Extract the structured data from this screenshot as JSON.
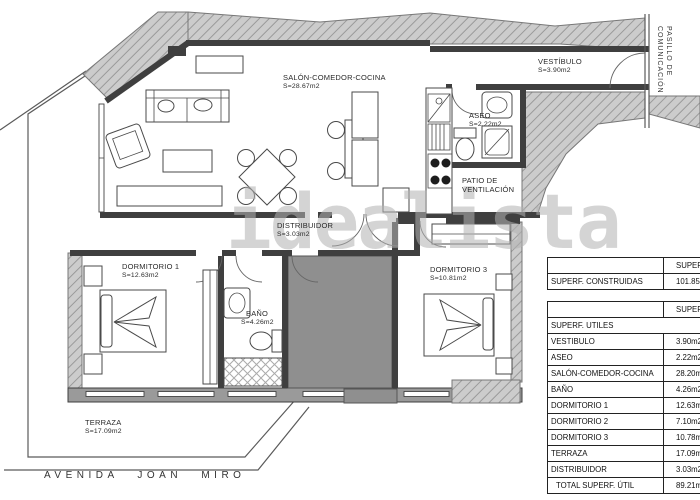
{
  "watermark_text": "idealista",
  "street_name": "AVENIDA JOAN MIRO",
  "corridor_label": "PASILLO DE\nCOMUNICACIÓN",
  "rooms": {
    "salon": {
      "name": "SALÓN-COMEDOR-COCINA",
      "area": "S=28.67m2"
    },
    "vestibulo": {
      "name": "VESTÍBULO",
      "area": "S=3.90m2"
    },
    "aseo": {
      "name": "ASEO",
      "area": "S=2.22m2"
    },
    "patio": {
      "name": "PATIO DE\nVENTILACIÓN"
    },
    "distribuidor": {
      "name": "DISTRIBUIDOR",
      "area": "S=3.03m2"
    },
    "dormitorio1": {
      "name": "DORMITORIO 1",
      "area": "S=12.63m2"
    },
    "dormitorio3": {
      "name": "DORMITORIO 3",
      "area": "S=10.81m2"
    },
    "bano": {
      "name": "BAÑO",
      "area": "S=4.26m2"
    },
    "terraza": {
      "name": "TERRAZA",
      "area": "S=17.09m2"
    }
  },
  "surface_tables": {
    "construidas": {
      "header": "SUPERFICIES",
      "rows": [
        {
          "label": "SUPERF. CONSTRUIDAS",
          "value": "101.85m2"
        }
      ]
    },
    "utiles": {
      "header": "SUPERFICIES",
      "section": "SUPERF. UTILES",
      "rows": [
        {
          "label": "VESTIBULO",
          "value": "3.90m2"
        },
        {
          "label": "ASEO",
          "value": "2.22m2"
        },
        {
          "label": "SALÓN-COMEDOR-COCINA",
          "value": "28.20m2"
        },
        {
          "label": "BAÑO",
          "value": "4.26m2"
        },
        {
          "label": "DORMITORIO 1",
          "value": "12.63m2"
        },
        {
          "label": "DORMITORIO 2",
          "value": "7.10m2"
        },
        {
          "label": "DORMITORIO 3",
          "value": "10.78m2"
        },
        {
          "label": "TERRAZA",
          "value": "17.09m2"
        },
        {
          "label": "DISTRIBUIDOR",
          "value": "3.03m2"
        },
        {
          "label": "TOTAL SUPERF. ÚTIL",
          "value": "89.21m2"
        }
      ]
    }
  },
  "colors": {
    "wall": "#3f3f3f",
    "wall-medium": "#9a9a9a",
    "hatch-bg": "#cccccc",
    "hatch-line": "#9a9a9a",
    "highlight-room": "#8f8f8f",
    "watermark": "#b2b2b2"
  }
}
